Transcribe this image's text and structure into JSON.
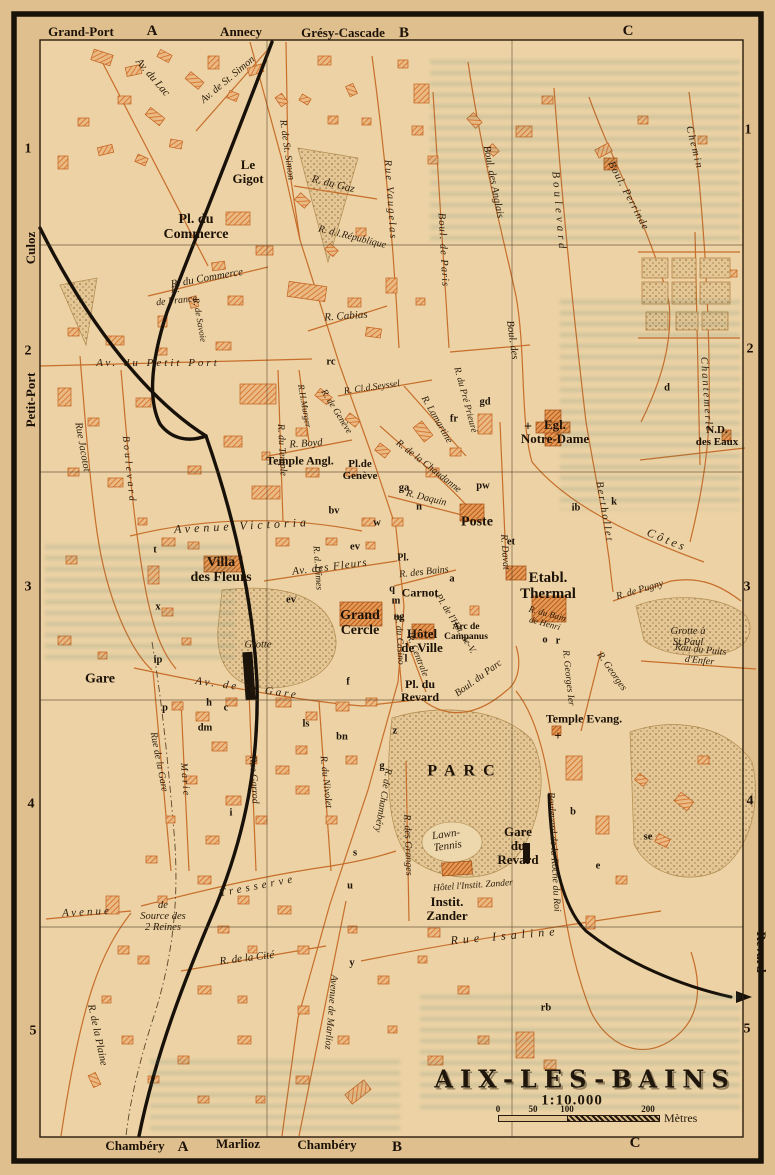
{
  "map": {
    "title": "AIX-LES-BAINS",
    "scale_text": "1:10.000",
    "scale_unit": "Mètres",
    "scale_ticks": [
      "0",
      "50",
      "100",
      "200"
    ]
  },
  "labels": [
    {
      "t": "Grand-Port",
      "x": 81,
      "y": 32,
      "c": "margin"
    },
    {
      "t": "A",
      "x": 152,
      "y": 31,
      "c": "glet"
    },
    {
      "t": "Annecy",
      "x": 241,
      "y": 32,
      "c": "margin"
    },
    {
      "t": "Grésy-Cascade",
      "x": 343,
      "y": 33,
      "c": "margin"
    },
    {
      "t": "B",
      "x": 404,
      "y": 33,
      "c": "glet"
    },
    {
      "t": "C",
      "x": 628,
      "y": 31,
      "c": "glet"
    },
    {
      "t": "Chambéry",
      "x": 135,
      "y": 1146,
      "c": "margin"
    },
    {
      "t": "A",
      "x": 183,
      "y": 1147,
      "c": "glet"
    },
    {
      "t": "Marlioz",
      "x": 238,
      "y": 1144,
      "c": "margin"
    },
    {
      "t": "Chambéry",
      "x": 327,
      "y": 1145,
      "c": "margin"
    },
    {
      "t": "B",
      "x": 397,
      "y": 1147,
      "c": "glet"
    },
    {
      "t": "C",
      "x": 635,
      "y": 1143,
      "c": "glet"
    },
    {
      "t": "Culoz",
      "x": 31,
      "y": 248,
      "r": -90,
      "c": "margin"
    },
    {
      "t": "Petit-Port",
      "x": 31,
      "y": 400,
      "r": -90,
      "c": "margin"
    },
    {
      "t": "Revard",
      "x": 761,
      "y": 952,
      "r": 90,
      "c": "margin"
    },
    {
      "t": "1",
      "x": 28,
      "y": 150,
      "c": "gnum"
    },
    {
      "t": "2",
      "x": 28,
      "y": 352,
      "c": "gnum"
    },
    {
      "t": "3",
      "x": 28,
      "y": 588,
      "c": "gnum"
    },
    {
      "t": "4",
      "x": 31,
      "y": 805,
      "c": "gnum"
    },
    {
      "t": "5",
      "x": 33,
      "y": 1032,
      "c": "gnum"
    },
    {
      "t": "1",
      "x": 748,
      "y": 131,
      "c": "gnum"
    },
    {
      "t": "2",
      "x": 750,
      "y": 350,
      "c": "gnum"
    },
    {
      "t": "3",
      "x": 747,
      "y": 588,
      "c": "gnum"
    },
    {
      "t": "4",
      "x": 750,
      "y": 802,
      "c": "gnum"
    },
    {
      "t": "5",
      "x": 747,
      "y": 1030,
      "c": "gnum"
    },
    {
      "t": "Le\nGigot",
      "x": 248,
      "y": 172,
      "s": 13,
      "c": "place"
    },
    {
      "t": "Pl. du\nCommerce",
      "x": 196,
      "y": 228,
      "s": 14,
      "c": "place"
    },
    {
      "t": "Temple Angl.",
      "x": 300,
      "y": 461,
      "s": 12,
      "c": "place"
    },
    {
      "t": "Pl.de\nGenève",
      "x": 360,
      "y": 471,
      "s": 11,
      "c": "place"
    },
    {
      "t": "Egl.\nNotre-Dame",
      "x": 555,
      "y": 432,
      "s": 13,
      "c": "place"
    },
    {
      "t": "N.D.\ndes Eaux",
      "x": 717,
      "y": 437,
      "s": 11,
      "c": "place"
    },
    {
      "t": "Poste",
      "x": 477,
      "y": 523,
      "s": 14,
      "c": "place"
    },
    {
      "t": "Villa\ndes Fleurs",
      "x": 221,
      "y": 571,
      "s": 14,
      "c": "place"
    },
    {
      "t": "Grand\nCercle",
      "x": 360,
      "y": 624,
      "s": 14,
      "c": "place"
    },
    {
      "t": "Hôtel\nde Ville",
      "x": 422,
      "y": 641,
      "s": 13,
      "c": "place"
    },
    {
      "t": "Etabl.\nThermal",
      "x": 548,
      "y": 586,
      "s": 15,
      "c": "place"
    },
    {
      "t": "Carnot",
      "x": 420,
      "y": 593,
      "s": 12,
      "c": "place"
    },
    {
      "t": "Pl.",
      "x": 403,
      "y": 559,
      "s": 10,
      "c": "place"
    },
    {
      "t": "Arc de\nCampanus",
      "x": 466,
      "y": 632,
      "s": 9.5,
      "c": "place"
    },
    {
      "t": "Gare",
      "x": 100,
      "y": 680,
      "s": 14,
      "c": "place"
    },
    {
      "t": "Pl. du\nRevard",
      "x": 420,
      "y": 691,
      "s": 12,
      "c": "place"
    },
    {
      "t": "Temple Evang.",
      "x": 584,
      "y": 719,
      "s": 12,
      "c": "place"
    },
    {
      "t": "PARC",
      "x": 465,
      "y": 771,
      "s": 16,
      "ls": 8,
      "c": "place"
    },
    {
      "t": "Gare\ndu\nRevard",
      "x": 518,
      "y": 846,
      "s": 13,
      "c": "place"
    },
    {
      "t": "Instit.\nZander",
      "x": 447,
      "y": 909,
      "s": 13,
      "c": "place"
    },
    {
      "t": "Grotte à\nSt.Paul",
      "x": 688,
      "y": 637,
      "s": 10.5,
      "c": "street"
    },
    {
      "t": "Lawn-\nTennis",
      "x": 447,
      "y": 841,
      "r": -8,
      "s": 11,
      "c": "street"
    },
    {
      "t": "Hôtel l'Instit. Zander",
      "x": 473,
      "y": 886,
      "r": -4,
      "s": 9.5,
      "c": "street"
    },
    {
      "t": "Grotte",
      "x": 258,
      "y": 645,
      "s": 10.5,
      "c": "street"
    },
    {
      "t": "de\nSource des\n2 Reines",
      "x": 163,
      "y": 917,
      "s": 10.5,
      "c": "street"
    },
    {
      "t": "Av. du Lac",
      "x": 152,
      "y": 78,
      "r": 49,
      "s": 11,
      "c": "street"
    },
    {
      "t": "Av. de St. Simon",
      "x": 228,
      "y": 80,
      "r": -40,
      "s": 10.5,
      "c": "street"
    },
    {
      "t": "R. de St. Simon",
      "x": 286,
      "y": 150,
      "r": 82,
      "s": 10,
      "c": "street"
    },
    {
      "t": "R. du Gaz",
      "x": 333,
      "y": 185,
      "r": 14,
      "s": 11,
      "c": "street"
    },
    {
      "t": "R. d.l.République",
      "x": 352,
      "y": 238,
      "r": 14,
      "s": 10,
      "c": "street"
    },
    {
      "t": "R. du Commerce",
      "x": 207,
      "y": 279,
      "r": -10,
      "s": 11,
      "c": "street"
    },
    {
      "t": "R.\nde France",
      "x": 176,
      "y": 296,
      "r": -6,
      "s": 10,
      "c": "street"
    },
    {
      "t": "R. de Savoie",
      "x": 199,
      "y": 320,
      "r": 80,
      "s": 9,
      "c": "street"
    },
    {
      "t": "R. Cabias",
      "x": 346,
      "y": 317,
      "r": -4,
      "s": 11,
      "c": "street"
    },
    {
      "t": "Rue Vaugelas",
      "x": 390,
      "y": 200,
      "r": 86,
      "s": 10.5,
      "ls": 2,
      "c": "street"
    },
    {
      "t": "Boul. de Paris",
      "x": 443,
      "y": 250,
      "r": 87,
      "s": 10.5,
      "ls": 1,
      "c": "street"
    },
    {
      "t": "R. du Pré Prieuré",
      "x": 465,
      "y": 400,
      "r": 75,
      "s": 9.5,
      "c": "street"
    },
    {
      "t": "Boul. des Anglais",
      "x": 493,
      "y": 182,
      "r": 79,
      "s": 10.5,
      "c": "street"
    },
    {
      "t": "Boul. des",
      "x": 512,
      "y": 340,
      "r": 82,
      "s": 10.5,
      "c": "street"
    },
    {
      "t": "Côtes",
      "x": 667,
      "y": 540,
      "r": 22,
      "s": 12,
      "ls": 3,
      "c": "street"
    },
    {
      "t": "Boulevard",
      "x": 558,
      "y": 212,
      "r": 85,
      "s": 11,
      "ls": 4,
      "c": "street"
    },
    {
      "t": "Berthollet",
      "x": 604,
      "y": 512,
      "r": 80,
      "s": 10.5,
      "ls": 2,
      "c": "street"
    },
    {
      "t": "Boul. Perrinde",
      "x": 628,
      "y": 196,
      "r": 62,
      "s": 10.5,
      "ls": 1,
      "c": "street"
    },
    {
      "t": "Chemin",
      "x": 694,
      "y": 148,
      "r": 76,
      "s": 10.5,
      "ls": 2,
      "c": "street"
    },
    {
      "t": "Chantemerle",
      "x": 706,
      "y": 395,
      "r": 86,
      "s": 10.5,
      "ls": 2,
      "c": "street"
    },
    {
      "t": "R.H.Murger",
      "x": 304,
      "y": 406,
      "r": 80,
      "s": 9,
      "c": "street"
    },
    {
      "t": "R. Boyd",
      "x": 306,
      "y": 444,
      "r": -4,
      "s": 10.5,
      "c": "street"
    },
    {
      "t": "R. de Genève",
      "x": 336,
      "y": 412,
      "r": 58,
      "s": 9.5,
      "c": "street"
    },
    {
      "t": "R. Cl.d.Seyssel",
      "x": 372,
      "y": 388,
      "r": -8,
      "s": 9.5,
      "c": "street"
    },
    {
      "t": "R. Lamartine",
      "x": 436,
      "y": 420,
      "r": 60,
      "s": 10,
      "c": "street"
    },
    {
      "t": "R. de la Chaudanne",
      "x": 428,
      "y": 467,
      "r": 38,
      "s": 10,
      "c": "street"
    },
    {
      "t": "R. Daquin",
      "x": 426,
      "y": 499,
      "r": 14,
      "s": 10,
      "c": "street"
    },
    {
      "t": "R. Davat",
      "x": 504,
      "y": 552,
      "r": 86,
      "s": 10,
      "c": "street"
    },
    {
      "t": "R. du Temple",
      "x": 281,
      "y": 450,
      "r": 87,
      "s": 10,
      "c": "street"
    },
    {
      "t": "Rue Jacotot",
      "x": 82,
      "y": 447,
      "r": 80,
      "s": 10.5,
      "c": "street"
    },
    {
      "t": "Boulevard",
      "x": 128,
      "y": 470,
      "r": 84,
      "s": 10,
      "ls": 3,
      "c": "street"
    },
    {
      "t": "Av. du Petit Port",
      "x": 158,
      "y": 364,
      "s": 11,
      "ls": 3,
      "c": "street"
    },
    {
      "t": "Avenue Victoria",
      "x": 242,
      "y": 526,
      "r": -3,
      "s": 12,
      "ls": 4,
      "c": "street"
    },
    {
      "t": "Av. des Fleurs",
      "x": 330,
      "y": 568,
      "r": -7,
      "s": 11,
      "ls": 1,
      "c": "street"
    },
    {
      "t": "R. d. Dîmes",
      "x": 317,
      "y": 568,
      "r": 86,
      "s": 9.5,
      "c": "street"
    },
    {
      "t": "R. du Casino",
      "x": 399,
      "y": 640,
      "r": 87,
      "s": 9.5,
      "c": "street"
    },
    {
      "t": "R. Centrale",
      "x": 417,
      "y": 656,
      "r": 68,
      "s": 9.5,
      "c": "street"
    },
    {
      "t": "Av. de la Gare",
      "x": 247,
      "y": 689,
      "r": 8,
      "s": 11,
      "ls": 3,
      "c": "street"
    },
    {
      "t": "Boul. du Parc",
      "x": 479,
      "y": 679,
      "r": -36,
      "s": 10,
      "c": "street"
    },
    {
      "t": "Pl. de l'Hôt.-de-V.",
      "x": 455,
      "y": 624,
      "r": 58,
      "s": 9.5,
      "c": "street"
    },
    {
      "t": "R. du Bain\nde Henri",
      "x": 546,
      "y": 619,
      "r": 15,
      "s": 9,
      "c": "street"
    },
    {
      "t": "R. de Pugny",
      "x": 640,
      "y": 591,
      "r": -16,
      "s": 10,
      "c": "street"
    },
    {
      "t": "Rau du Puits d'Enfer",
      "x": 700,
      "y": 656,
      "r": 6,
      "s": 10,
      "c": "street"
    },
    {
      "t": "R. Georges Ier",
      "x": 568,
      "y": 678,
      "r": 84,
      "s": 9.5,
      "c": "street"
    },
    {
      "t": "R. Georges",
      "x": 611,
      "y": 672,
      "r": 55,
      "s": 10,
      "c": "street"
    },
    {
      "t": "Boulevard de la Roche du Roi",
      "x": 553,
      "y": 852,
      "r": 87,
      "s": 10,
      "c": "street"
    },
    {
      "t": "Rue Garrod",
      "x": 253,
      "y": 780,
      "r": 87,
      "s": 10,
      "c": "street"
    },
    {
      "t": "R. du Nivolet",
      "x": 325,
      "y": 782,
      "r": 84,
      "s": 10,
      "c": "street"
    },
    {
      "t": "Marie",
      "x": 184,
      "y": 780,
      "r": 85,
      "s": 10,
      "ls": 2,
      "c": "street"
    },
    {
      "t": "Rue de la Gare",
      "x": 158,
      "y": 762,
      "r": 79,
      "s": 10,
      "c": "street"
    },
    {
      "t": "R. de Chambéry",
      "x": 382,
      "y": 800,
      "r": 100,
      "s": 10,
      "c": "street"
    },
    {
      "t": "R. des Granges",
      "x": 407,
      "y": 845,
      "r": 88,
      "s": 10,
      "c": "street"
    },
    {
      "t": "Avenue de Marlioz",
      "x": 330,
      "y": 1012,
      "r": 95,
      "s": 10,
      "c": "street"
    },
    {
      "t": "Rue Isaline",
      "x": 505,
      "y": 936,
      "r": -5,
      "s": 12,
      "ls": 5,
      "c": "street"
    },
    {
      "t": "R. de la Cité",
      "x": 247,
      "y": 959,
      "r": -7,
      "s": 11,
      "c": "street"
    },
    {
      "t": "Tresserve",
      "x": 258,
      "y": 887,
      "r": -11,
      "s": 11,
      "ls": 4,
      "c": "street"
    },
    {
      "t": "Avenue",
      "x": 87,
      "y": 913,
      "r": -3,
      "s": 11,
      "ls": 3,
      "c": "street"
    },
    {
      "t": "R. de la Plaine",
      "x": 97,
      "y": 1035,
      "r": 78,
      "s": 10.5,
      "c": "street"
    },
    {
      "t": "R. des Bains",
      "x": 424,
      "y": 573,
      "r": -6,
      "s": 10,
      "c": "street"
    },
    {
      "t": "rc",
      "x": 331,
      "y": 362,
      "c": "mark",
      "s": 10.5
    },
    {
      "t": "gd",
      "x": 485,
      "y": 402,
      "c": "mark",
      "s": 10.5
    },
    {
      "t": "fr",
      "x": 454,
      "y": 419,
      "c": "mark",
      "s": 10.5
    },
    {
      "t": "ga",
      "x": 404,
      "y": 488,
      "c": "mark",
      "s": 10.5
    },
    {
      "t": "n",
      "x": 419,
      "y": 507,
      "c": "mark",
      "s": 10.5
    },
    {
      "t": "pw",
      "x": 483,
      "y": 486,
      "c": "mark",
      "s": 10.5
    },
    {
      "t": "et",
      "x": 511,
      "y": 542,
      "c": "mark",
      "s": 10.5
    },
    {
      "t": "ib",
      "x": 576,
      "y": 508,
      "c": "mark",
      "s": 10.5
    },
    {
      "t": "k",
      "x": 614,
      "y": 502,
      "c": "mark",
      "s": 10.5
    },
    {
      "t": "d",
      "x": 667,
      "y": 388,
      "c": "mark",
      "s": 10.5
    },
    {
      "t": "bv",
      "x": 334,
      "y": 511,
      "c": "mark",
      "s": 10.5
    },
    {
      "t": "w",
      "x": 377,
      "y": 523,
      "c": "mark",
      "s": 10.5
    },
    {
      "t": "ev",
      "x": 355,
      "y": 547,
      "c": "mark",
      "s": 10.5
    },
    {
      "t": "ev",
      "x": 291,
      "y": 600,
      "c": "mark",
      "s": 10.5
    },
    {
      "t": "t",
      "x": 155,
      "y": 550,
      "c": "mark",
      "s": 10.5
    },
    {
      "t": "x",
      "x": 158,
      "y": 607,
      "c": "mark",
      "s": 10.5
    },
    {
      "t": "ip",
      "x": 158,
      "y": 660,
      "c": "mark",
      "s": 10.5
    },
    {
      "t": "p",
      "x": 165,
      "y": 708,
      "c": "mark",
      "s": 10.5
    },
    {
      "t": "h",
      "x": 209,
      "y": 703,
      "c": "mark",
      "s": 10.5
    },
    {
      "t": "c",
      "x": 226,
      "y": 708,
      "c": "mark",
      "s": 10.5
    },
    {
      "t": "dm",
      "x": 205,
      "y": 728,
      "c": "mark",
      "s": 10.5
    },
    {
      "t": "ls",
      "x": 306,
      "y": 724,
      "c": "mark",
      "s": 10.5
    },
    {
      "t": "bn",
      "x": 342,
      "y": 737,
      "c": "mark",
      "s": 10.5
    },
    {
      "t": "f",
      "x": 348,
      "y": 682,
      "c": "mark",
      "s": 10.5
    },
    {
      "t": "g",
      "x": 382,
      "y": 766,
      "c": "mark",
      "s": 10.5
    },
    {
      "t": "i",
      "x": 231,
      "y": 813,
      "c": "mark",
      "s": 10.5
    },
    {
      "t": "s",
      "x": 355,
      "y": 853,
      "c": "mark",
      "s": 10.5
    },
    {
      "t": "u",
      "x": 350,
      "y": 886,
      "c": "mark",
      "s": 10.5
    },
    {
      "t": "z",
      "x": 395,
      "y": 731,
      "c": "mark",
      "s": 10.5
    },
    {
      "t": "y",
      "x": 352,
      "y": 963,
      "c": "mark",
      "s": 10.5
    },
    {
      "t": "b",
      "x": 573,
      "y": 812,
      "c": "mark",
      "s": 10.5
    },
    {
      "t": "e",
      "x": 598,
      "y": 866,
      "c": "mark",
      "s": 10.5
    },
    {
      "t": "se",
      "x": 648,
      "y": 837,
      "c": "mark",
      "s": 10.5
    },
    {
      "t": "rb",
      "x": 546,
      "y": 1008,
      "c": "mark",
      "s": 10.5
    },
    {
      "t": "q",
      "x": 392,
      "y": 589,
      "c": "mark",
      "s": 10.5
    },
    {
      "t": "m",
      "x": 396,
      "y": 601,
      "c": "mark",
      "s": 10.5
    },
    {
      "t": "ng",
      "x": 399,
      "y": 617,
      "c": "mark",
      "s": 10.5
    },
    {
      "t": "l",
      "x": 406,
      "y": 659,
      "c": "mark",
      "s": 10.5
    },
    {
      "t": "o",
      "x": 545,
      "y": 640,
      "c": "mark",
      "s": 10.5
    },
    {
      "t": "r",
      "x": 558,
      "y": 641,
      "c": "mark",
      "s": 10.5
    },
    {
      "t": "a",
      "x": 452,
      "y": 579,
      "c": "mark",
      "s": 10.5
    },
    {
      "t": "+",
      "x": 528,
      "y": 428,
      "c": "cross",
      "s": 14
    },
    {
      "t": "+",
      "x": 558,
      "y": 736,
      "c": "cross",
      "s": 13
    }
  ]
}
